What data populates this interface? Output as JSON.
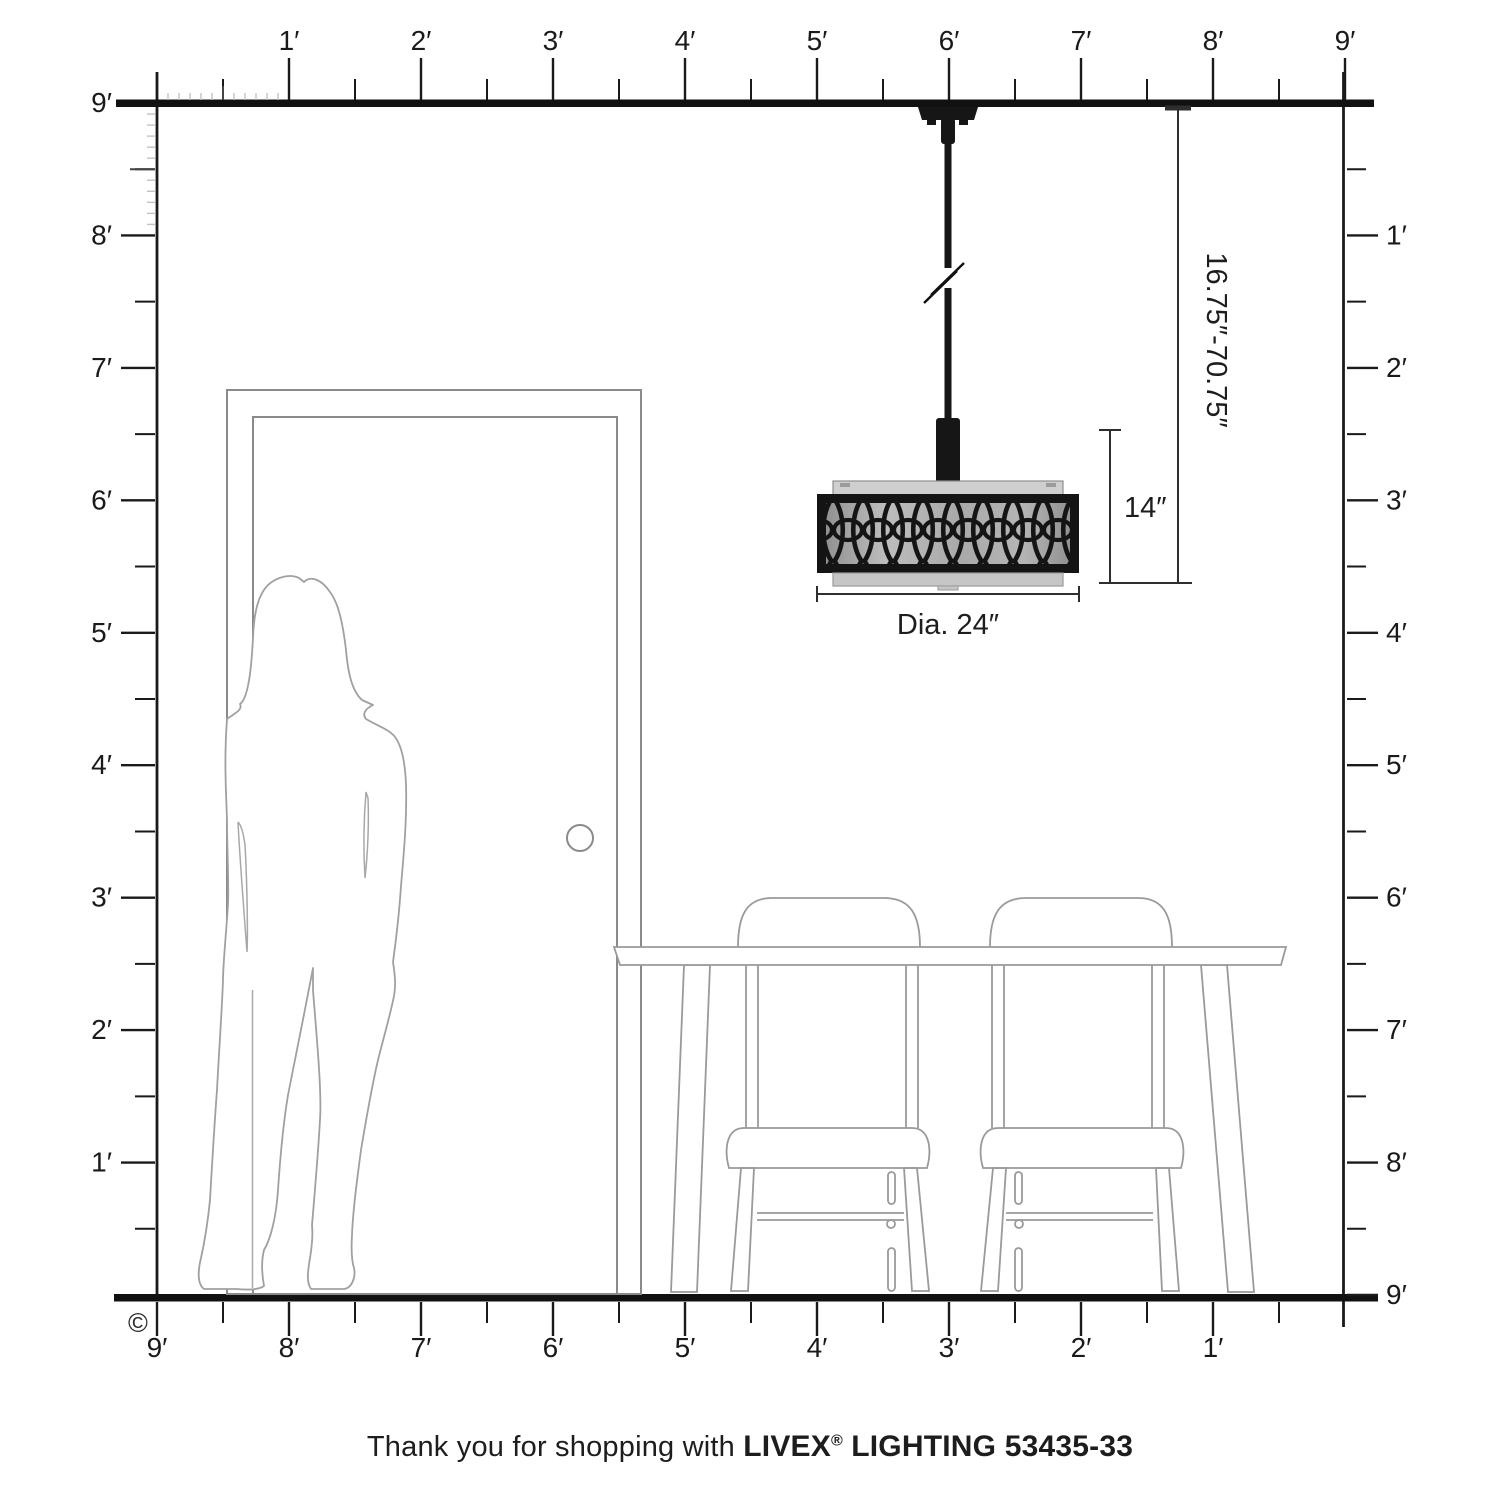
{
  "rulers": {
    "top": [
      "1′",
      "2′",
      "3′",
      "4′",
      "5′",
      "6′",
      "7′",
      "8′",
      "9′"
    ],
    "left": [
      "9′",
      "8′",
      "7′",
      "6′",
      "5′",
      "4′",
      "3′",
      "2′",
      "1′"
    ],
    "right": [
      "1′",
      "2′",
      "3′",
      "4′",
      "5′",
      "6′",
      "7′",
      "8′",
      "9′"
    ],
    "bottom": [
      "9′",
      "8′",
      "7′",
      "6′",
      "5′",
      "4′",
      "3′",
      "2′",
      "1′"
    ]
  },
  "dimensions": {
    "height_range": "16.75″-70.75″",
    "fixture_height": "14″",
    "diameter": "Dia. 24″"
  },
  "caption": {
    "prefix": "Thank you for shopping with",
    "brand": "LIVEX",
    "registered": "®",
    "suffix": "LIGHTING 53435-33"
  },
  "copyright": "©",
  "colors": {
    "ruler": "#1a1a1a",
    "outline": "#9a9a9a",
    "door": "#8a8a8a",
    "fixture": "#161616",
    "dimension": "#2e2e2e",
    "inch_tick": "#c2c2c2"
  }
}
